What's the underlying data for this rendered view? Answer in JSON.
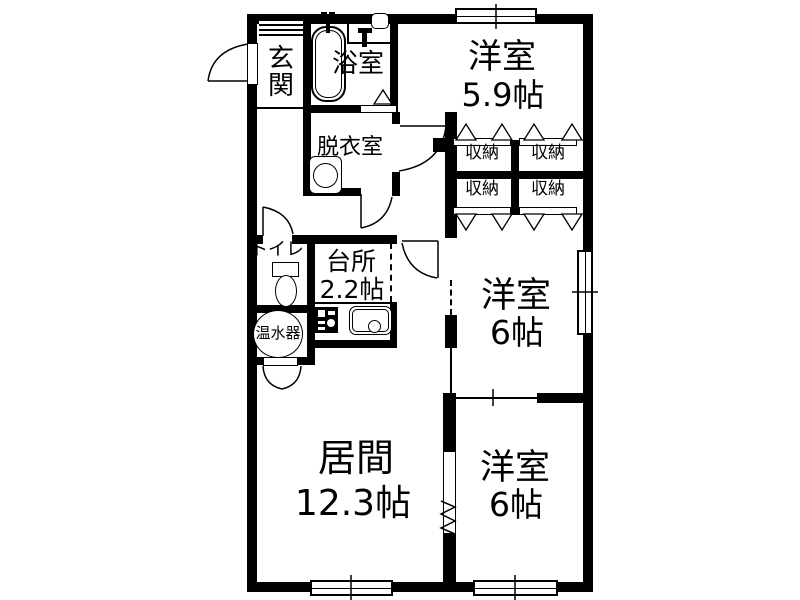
{
  "title": "apartment-floor-plan",
  "colors": {
    "wall": "#000000",
    "background": "#ffffff",
    "line": "#000000"
  },
  "rooms": {
    "genkan": {
      "label": "玄関"
    },
    "bathroom": {
      "label": "浴室"
    },
    "dressing": {
      "label": "脱衣室"
    },
    "bedroom1": {
      "label": "洋室",
      "size": "5.9帖"
    },
    "toilet": {
      "label": "トイレ"
    },
    "kitchen": {
      "label": "台所",
      "size": "2.2帖"
    },
    "water_heater": {
      "label": "温水器"
    },
    "bedroom2": {
      "label": "洋室",
      "size": "6帖"
    },
    "living": {
      "label": "居間",
      "size": "12.3帖"
    },
    "bedroom3": {
      "label": "洋室",
      "size": "6帖"
    }
  },
  "storages": [
    "収納",
    "収納",
    "収納",
    "収納"
  ],
  "icons": {
    "bathtub": "rounded-rect",
    "faucet": "t-shape",
    "wash_basin": "rounded-rect",
    "washing_machine": "rect-with-circle",
    "toilet": "tank-and-bowl",
    "water_heater": "circle",
    "stove": "black-square",
    "sink": "rounded-rect-with-drain",
    "door_swing": "quarter-arc",
    "folding_door": "triangle",
    "accordion_door": "zigzag"
  }
}
